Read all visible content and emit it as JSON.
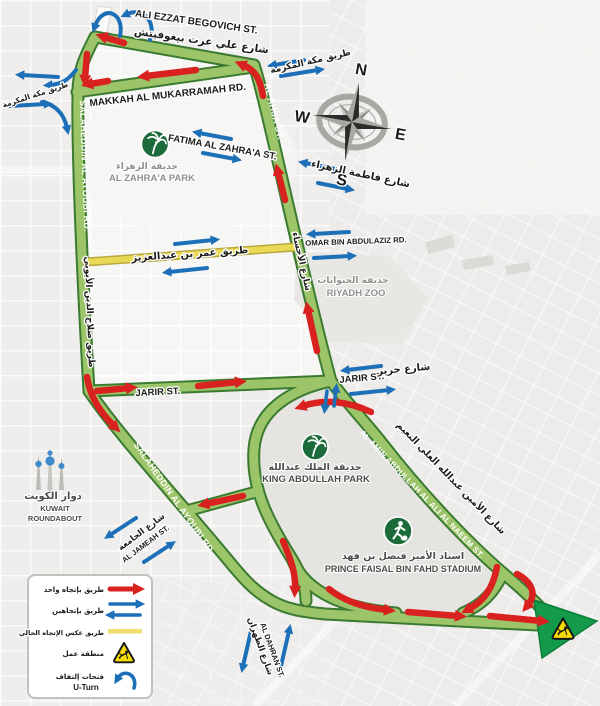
{
  "colors": {
    "road_green_fill": "#9cc468",
    "road_green_border": "#3a7a31",
    "one_way_red": "#d92120",
    "two_way_blue": "#1d70b8",
    "contraflow_yellow": "#e9d955",
    "park_icon_green": "#1c6b3a",
    "warning_yellow": "#f7da00"
  },
  "compass": {
    "n": "N",
    "e": "E",
    "s": "S",
    "w": "W"
  },
  "streets": {
    "ali_ezzat": {
      "en": "ALI EZZAT BEGOVICH ST.",
      "ar": "شارع علي عزت بيغوفيتش"
    },
    "makkah": {
      "en": "MAKKAH AL MUKARRAMAH RD.",
      "ar": "طريق مكة المكرمة"
    },
    "salaheddin": {
      "en": "SALAHEDDIN AL AYOUBI RD.",
      "ar": "طريق صلاح الدين الأيوبي"
    },
    "al_ahsa": {
      "en": "AL AHSA ST.",
      "ar": "شارع الأحساء"
    },
    "fatima": {
      "en": "FATIMA AL ZAHRA'A ST.",
      "ar": "شارع فاطمة الزهراء"
    },
    "omar": {
      "en": "OMAR BIN ABDULAZIZ RD.",
      "ar": "طريق عمر بن عبدالعزيز"
    },
    "jarir": {
      "en": "JARIR ST.",
      "ar": "شارع جرير"
    },
    "naeem": {
      "en": "AL AMIN ABDULLAH AL ALI AL NAEEM ST.",
      "ar": "شارع الأمين عبدالله العلي النعيم"
    },
    "dahran": {
      "en": "AL DAHRAN ST.",
      "ar": "شارع الظهران"
    },
    "jameah": {
      "en": "AL JAMEAH ST.",
      "ar": "شارع الجامعة"
    }
  },
  "places": {
    "zahra_park": {
      "ar": "حديقة الزهراء",
      "en": "AL ZAHRA'A PARK"
    },
    "riyadh_zoo": {
      "ar": "حديقة الحيوانات",
      "en": "RIYADH ZOO"
    },
    "king_abdullah_park": {
      "ar": "حديقة الملك عبدالله",
      "en": "KING ABDULLAH PARK"
    },
    "stadium": {
      "ar": "استاد الأمير فيصل بن فهد",
      "en": "PRINCE FAISAL BIN FAHD STADIUM"
    },
    "kuwait_roundabout": {
      "ar": "دوار الكويت",
      "en_line1": "KUWAIT",
      "en_line2": "ROUNDABOUT"
    }
  },
  "legend": {
    "one_way": "طريق بإتجاه واحد",
    "two_way": "طريق بإتجاهين",
    "contraflow": "طريق عكس الإتجاه الحالي",
    "work_zone": "منطقة عمل",
    "u_turn_ar": "فتحات إلتفاف",
    "u_turn_en": "U-Turn"
  }
}
